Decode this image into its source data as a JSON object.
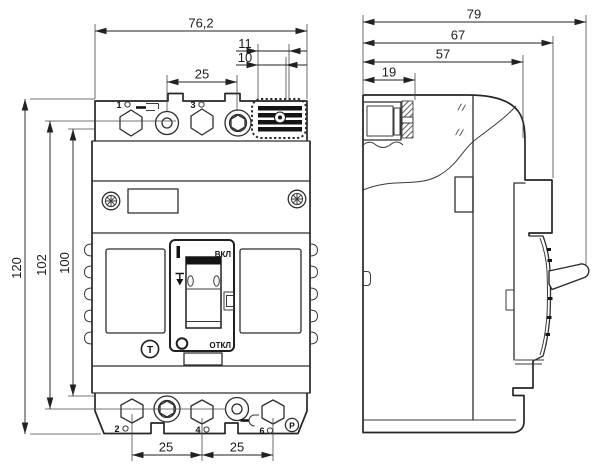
{
  "front_view": {
    "dimensions": {
      "overall_width": "76,2",
      "detail_outer": "11",
      "detail_inner": "10",
      "terminal_pitch_top": "25",
      "overall_height": "120",
      "mounting_height": "102",
      "inner_height": "100",
      "terminal_pitch_bottom_left": "25",
      "terminal_pitch_bottom_right": "25"
    },
    "terminal_labels": {
      "top_left": "1",
      "top_mid": "3",
      "bottom_left": "2",
      "bottom_mid": "4",
      "bottom_right": "6"
    },
    "markings": {
      "on": "ВКЛ",
      "off": "ОТКЛ",
      "test": "Т",
      "aux": "Р"
    }
  },
  "side_view": {
    "dimensions": {
      "overall_depth": "79",
      "depth_to_bezel": "67",
      "depth_to_cover": "57",
      "terminal_depth": "19"
    }
  }
}
